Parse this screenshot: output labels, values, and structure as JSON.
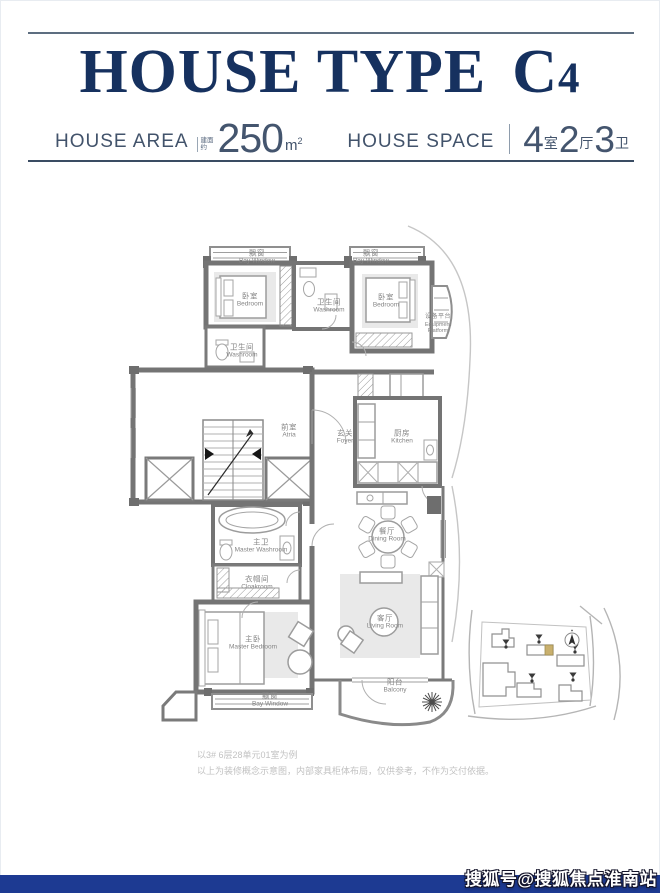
{
  "header": {
    "title": "HOUSE TYPE",
    "title_model": "C",
    "title_model_digit": "4",
    "area": {
      "label": "HOUSE AREA",
      "prefix_small": "建面约",
      "value": "250",
      "unit_m": "m",
      "unit_sup": "2"
    },
    "space": {
      "label": "HOUSE SPACE",
      "part1_num": "4",
      "part1_unit": "室",
      "part2_num": "2",
      "part2_unit": "厅",
      "part3_num": "3",
      "part3_unit": "卫"
    }
  },
  "floorplan": {
    "rooms": [
      {
        "zh": "飘窗",
        "en": "Bay Window"
      },
      {
        "zh": "卧室",
        "en": "Bedroom"
      },
      {
        "zh": "卫生间",
        "en": "Washroom"
      },
      {
        "zh": "飘窗",
        "en": "Bay Window"
      },
      {
        "zh": "卧室",
        "en": "Bedroom"
      },
      {
        "zh": "设备平台",
        "en": "Equipment Platform"
      },
      {
        "zh": "卫生间",
        "en": "Washroom"
      },
      {
        "zh": "前室",
        "en": "Atria"
      },
      {
        "zh": "玄关",
        "en": "Foyer"
      },
      {
        "zh": "厨房",
        "en": "Kitchen"
      },
      {
        "zh": "餐厅",
        "en": "Dining Room"
      },
      {
        "zh": "客厅",
        "en": "Living Room"
      },
      {
        "zh": "阳台",
        "en": "Balcony"
      },
      {
        "zh": "主卫",
        "en": "Master Washroom"
      },
      {
        "zh": "衣帽间",
        "en": "Cloakroom"
      },
      {
        "zh": "主卧",
        "en": "Master Bedroom"
      },
      {
        "zh": "飘窗",
        "en": "Bay Window"
      }
    ]
  },
  "notes": {
    "line1": "以3# 6层28单元01室为例",
    "line2": "以上为装修概念示意图，内部家具柜体布局，仅供参考，不作为交付依据。"
  },
  "watermark": "搜狐号@搜狐焦点淮南站",
  "colors": {
    "title_navy": "#16315f",
    "subtext": "#42536b",
    "bar_blue": "#1d3a92",
    "wall_gray": "#747474",
    "highlight_building": "#c9b06e"
  }
}
